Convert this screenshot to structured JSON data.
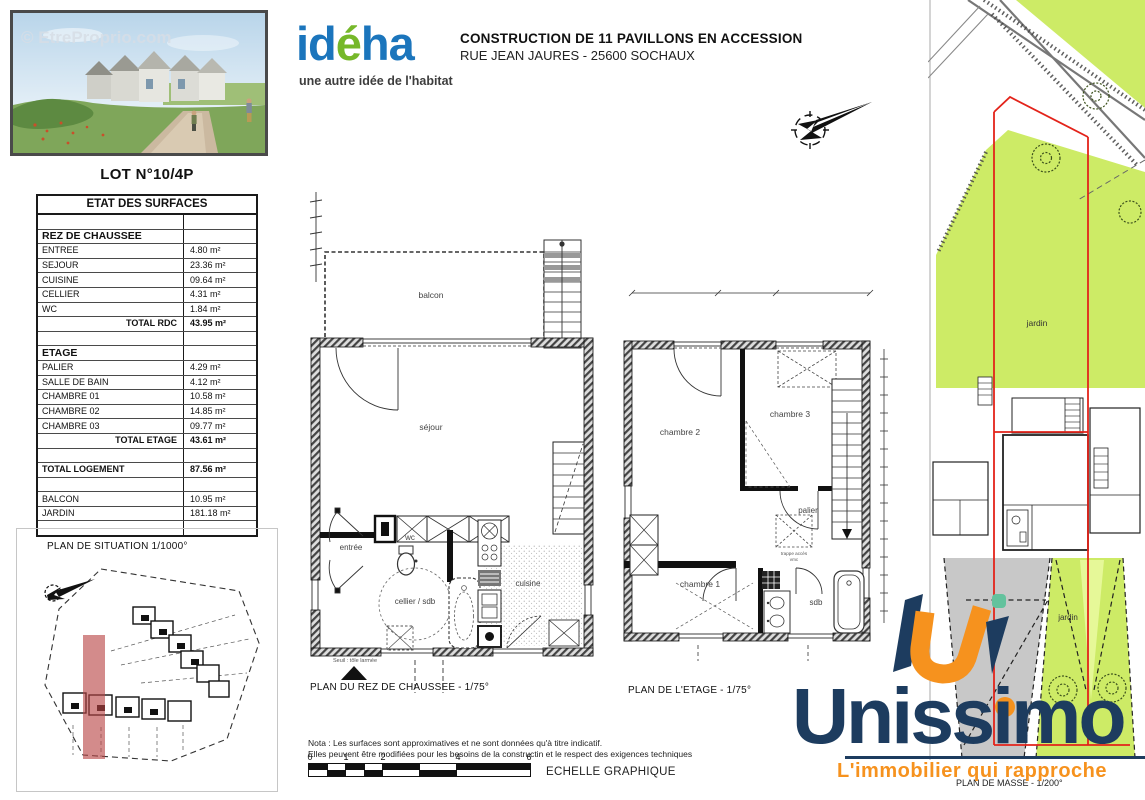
{
  "colors": {
    "ideha_blue": "#1b75bc",
    "ideha_green": "#76b82a",
    "unissimo_navy": "#1d3c5f",
    "unissimo_orange": "#f6921e",
    "jardin_green": "#cde966",
    "lot_red": "#e3231a",
    "drive_gray": "#c8c8c8"
  },
  "photo": {
    "watermark": "© EtreProprio.com"
  },
  "lot": {
    "title": "LOT N°10/4P"
  },
  "surface_table": {
    "title": "ETAT DES SURFACES",
    "rows": [
      {
        "label": "",
        "value": "",
        "style": "blank"
      },
      {
        "label": "REZ DE CHAUSSEE",
        "value": "",
        "style": "section"
      },
      {
        "label": "ENTREE",
        "value": "4.80 m²",
        "style": "item"
      },
      {
        "label": "SEJOUR",
        "value": "23.36 m²",
        "style": "item"
      },
      {
        "label": "CUISINE",
        "value": "09.64 m²",
        "style": "item"
      },
      {
        "label": "CELLIER",
        "value": "4.31 m²",
        "style": "item"
      },
      {
        "label": "WC",
        "value": "1.84 m²",
        "style": "item"
      },
      {
        "label": "TOTAL RDC",
        "value": "43.95 m²",
        "style": "total"
      },
      {
        "label": "",
        "value": "",
        "style": "blank"
      },
      {
        "label": "ETAGE",
        "value": "",
        "style": "section"
      },
      {
        "label": "PALIER",
        "value": "4.29 m²",
        "style": "item"
      },
      {
        "label": "SALLE DE BAIN",
        "value": "4.12 m²",
        "style": "item"
      },
      {
        "label": "CHAMBRE 01",
        "value": "10.58 m²",
        "style": "item"
      },
      {
        "label": "CHAMBRE 02",
        "value": "14.85 m²",
        "style": "item"
      },
      {
        "label": "CHAMBRE 03",
        "value": "09.77 m²",
        "style": "item"
      },
      {
        "label": "TOTAL ETAGE",
        "value": "43.61 m²",
        "style": "total"
      },
      {
        "label": "",
        "value": "",
        "style": "blank"
      },
      {
        "label": "TOTAL LOGEMENT",
        "value": "87.56 m²",
        "style": "total-left"
      },
      {
        "label": "",
        "value": "",
        "style": "blank"
      },
      {
        "label": "BALCON",
        "value": "10.95 m²",
        "style": "item"
      },
      {
        "label": "JARDIN",
        "value": "181.18 m²",
        "style": "item"
      },
      {
        "label": "",
        "value": "",
        "style": "blank"
      }
    ]
  },
  "header": {
    "logo_part1": "id",
    "logo_part2": "é",
    "logo_part3": "ha",
    "logo_tagline": "une autre idée de l'habitat",
    "title_line1": "CONSTRUCTION DE 11 PAVILLONS EN ACCESSION",
    "title_line2": "RUE JEAN JAURES - 25600 SOCHAUX"
  },
  "plans": {
    "situation": {
      "caption": "PLAN DE SITUATION 1/1000°"
    },
    "rdc": {
      "caption": "PLAN DU REZ DE CHAUSSEE - 1/75°",
      "labels": {
        "balcon": "balcon",
        "sejour": "séjour",
        "entree": "entrée",
        "wc": "wc",
        "cellier": "cellier / sdb",
        "cuisine": "cuisine",
        "seuil": "Seuil : tôle larmée"
      }
    },
    "etage": {
      "caption": "PLAN DE L'ETAGE - 1/75°",
      "labels": {
        "chambre2": "chambre 2",
        "chambre3": "chambre 3",
        "palier": "palier",
        "chambre1": "chambre 1",
        "sdb": "sdb",
        "trappe1": "trappe accès",
        "trappe2": "vmc"
      }
    },
    "masse": {
      "caption": "PLAN DE MASSE - 1/200°",
      "labels": {
        "jardin_top": "jardin",
        "jardin_bottom": "jardin"
      }
    }
  },
  "nota": {
    "line1": "Nota : Les surfaces sont approximatives et ne sont données qu'à titre indicatif.",
    "line2": "Elles peuvent être modifiées pour les besoins de la constructin et le respect des exigences techniques"
  },
  "scale_bar": {
    "ticks": [
      "0",
      "1",
      "2",
      "4",
      "6"
    ],
    "label": "ECHELLE GRAPHIQUE"
  },
  "agency": {
    "name": "Unissimo",
    "tagline": "L'immobilier qui rapproche"
  }
}
